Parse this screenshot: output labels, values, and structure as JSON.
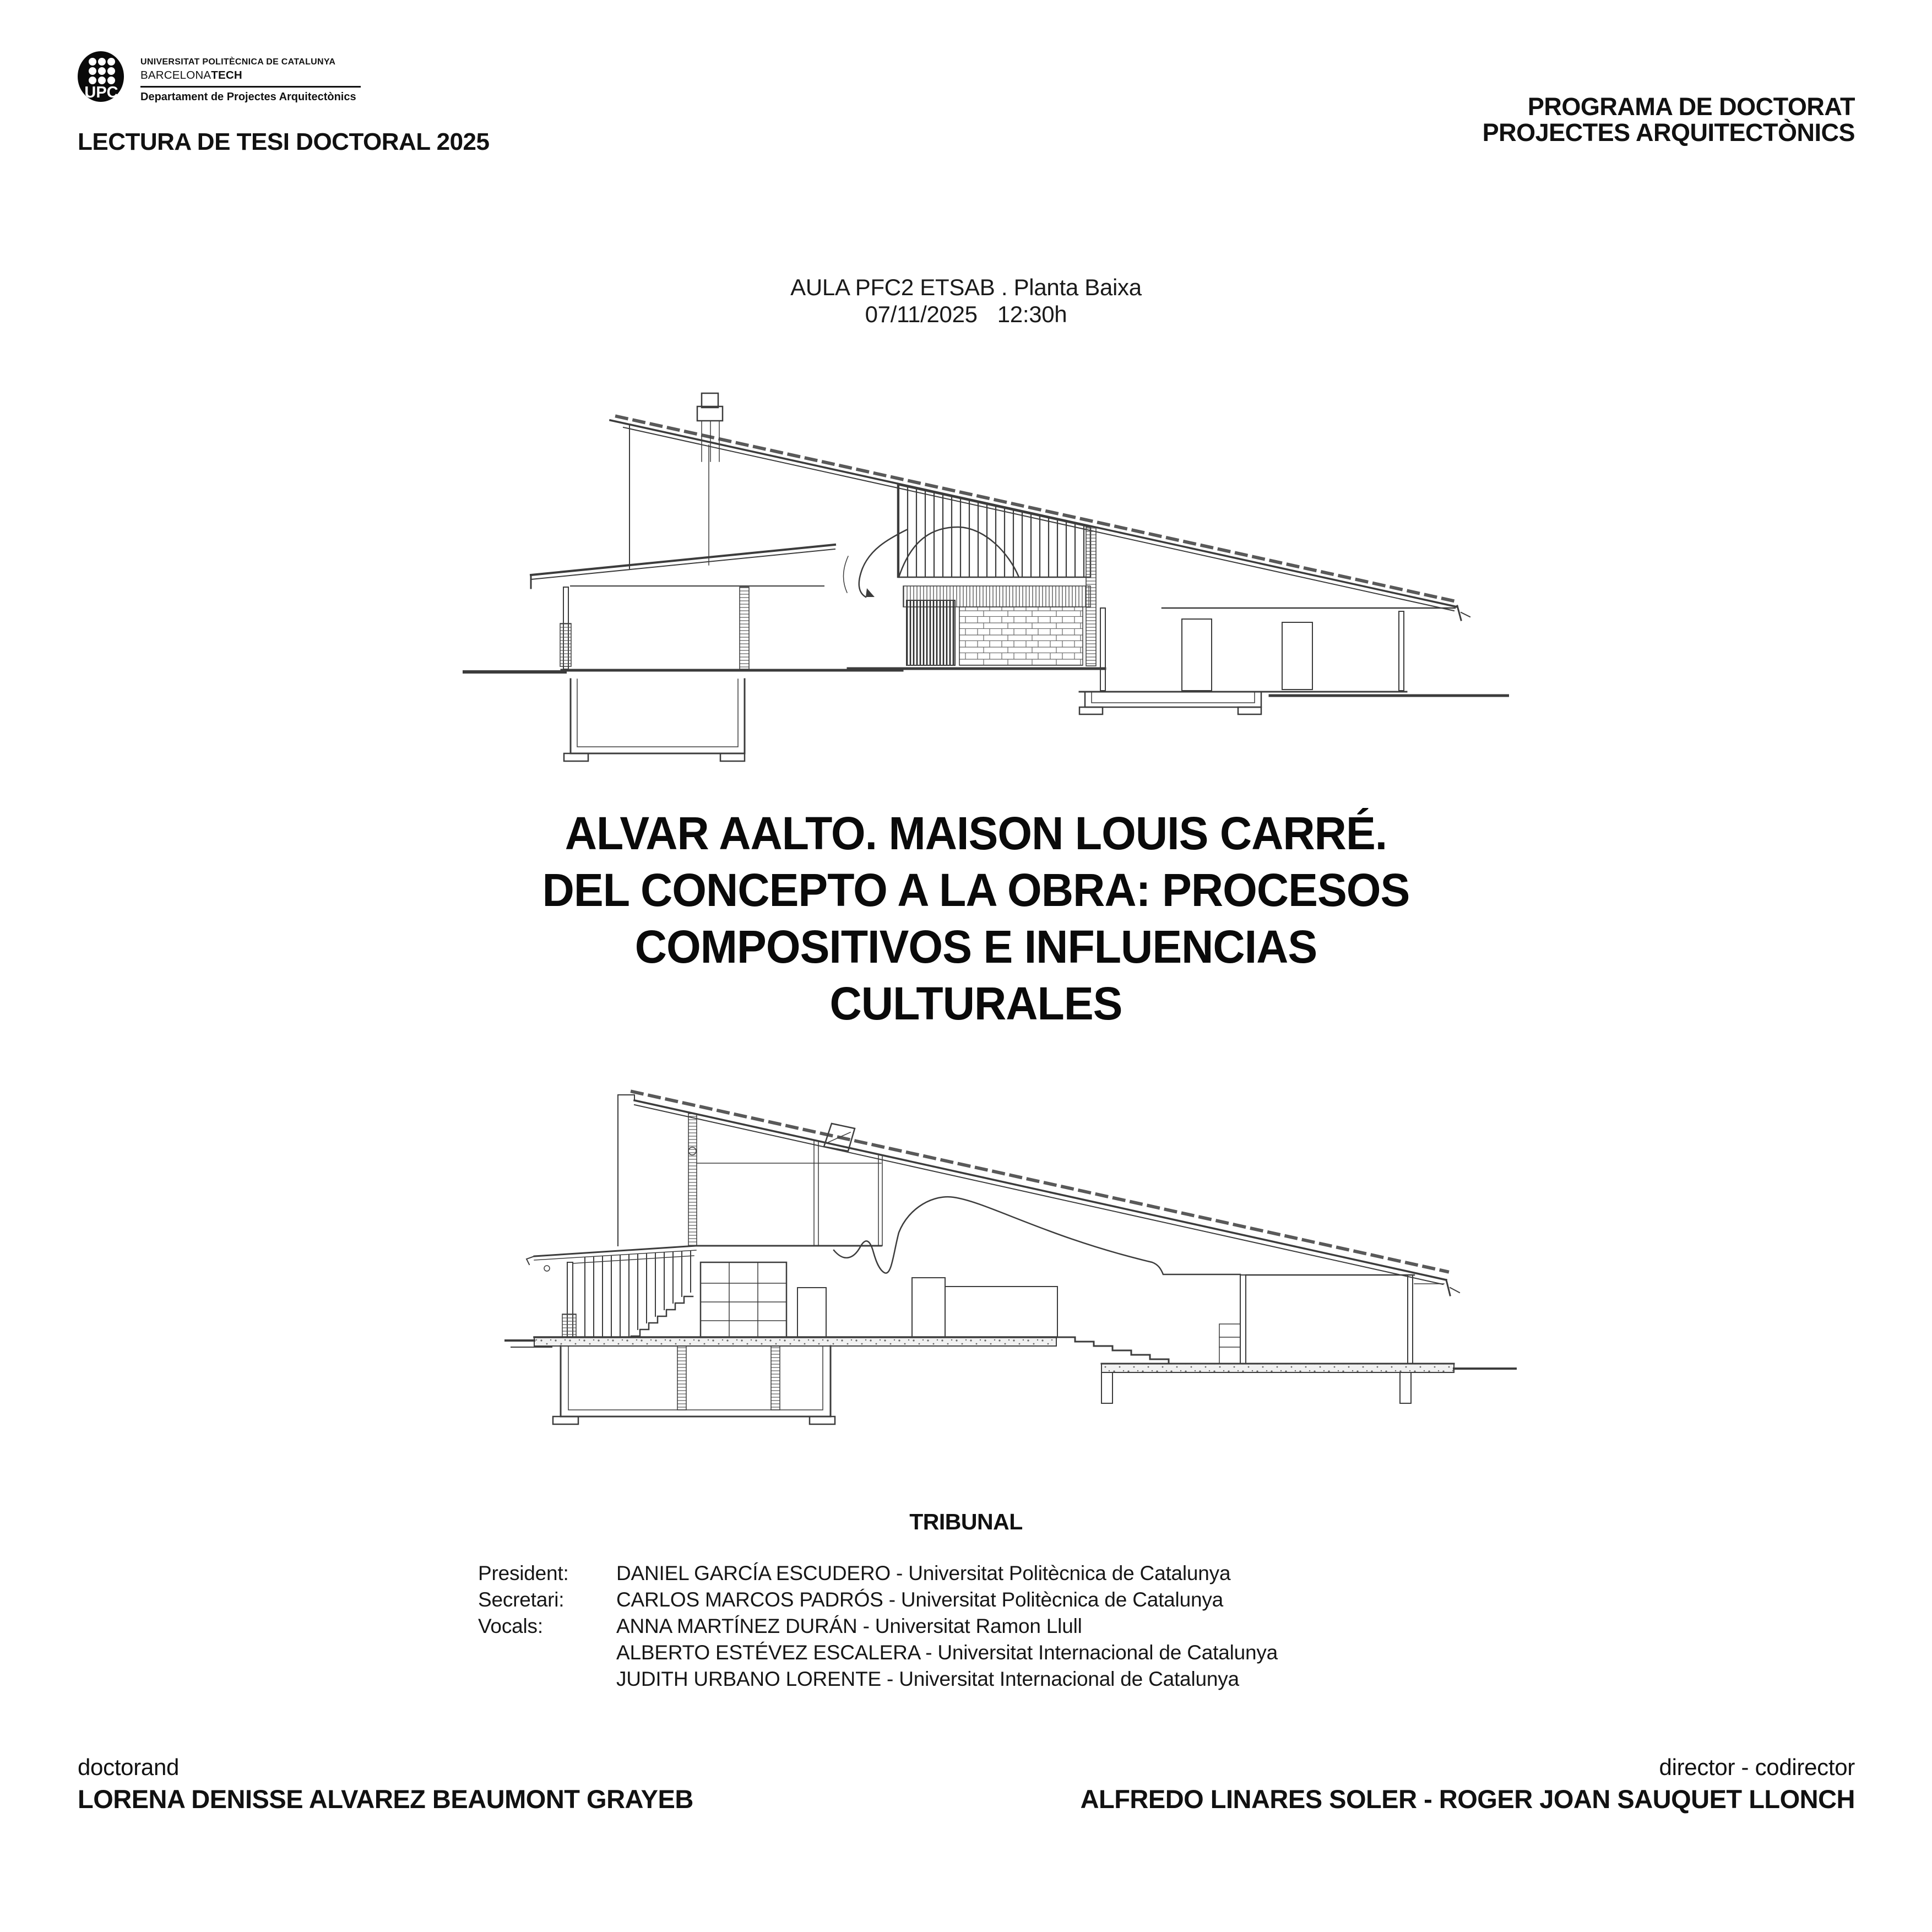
{
  "header": {
    "logo": {
      "acronym": "UPC",
      "university_line": "UNIVERSITAT POLITÈCNICA DE CATALUNYA",
      "brand_regular": "BARCELONA",
      "brand_bold": "TECH",
      "department": "Departament de Projectes Arquitectònics"
    },
    "event_title": "LECTURA DE TESI DOCTORAL 2025",
    "program": {
      "line1": "PROGRAMA DE DOCTORAT",
      "line2": "PROJECTES ARQUITECTÒNICS"
    }
  },
  "session": {
    "venue": "AULA PFC2 ETSAB . Planta Baixa",
    "date": "07/11/2025",
    "time": "12:30h"
  },
  "thesis": {
    "title_lines": [
      "ALVAR AALTO. MAISON LOUIS CARRÉ.",
      "DEL CONCEPTO A LA OBRA: PROCESOS",
      "COMPOSITIVOS E INFLUENCIAS",
      "CULTURALES"
    ]
  },
  "tribunal": {
    "heading": "TRIBUNAL",
    "separator": " - ",
    "members": [
      {
        "role": "President:",
        "name": "DANIEL GARCÍA ESCUDERO",
        "affiliation": "Universitat Politècnica de Catalunya"
      },
      {
        "role": "Secretari:",
        "name": "CARLOS MARCOS PADRÓS",
        "affiliation": "Universitat Politècnica de Catalunya"
      },
      {
        "role": "Vocals:",
        "name": "ANNA MARTÍNEZ DURÁN",
        "affiliation": "Universitat Ramon Llull"
      },
      {
        "role": "",
        "name": "ALBERTO ESTÉVEZ ESCALERA",
        "affiliation": "Universitat Internacional de Catalunya"
      },
      {
        "role": "",
        "name": "JUDITH URBANO LORENTE",
        "affiliation": "Universitat Internacional de Catalunya"
      }
    ]
  },
  "footer": {
    "doctorand_label": "doctorand",
    "doctorand_name": "LORENA DENISSE ALVAREZ BEAUMONT GRAYEB",
    "director_label": "director - codirector",
    "director_names": "ALFREDO LINARES SOLER - ROGER JOAN SAUQUET LLONCH"
  },
  "colors": {
    "ink": "#111111",
    "drawing_line": "#3c3c3c",
    "background": "#ffffff"
  }
}
